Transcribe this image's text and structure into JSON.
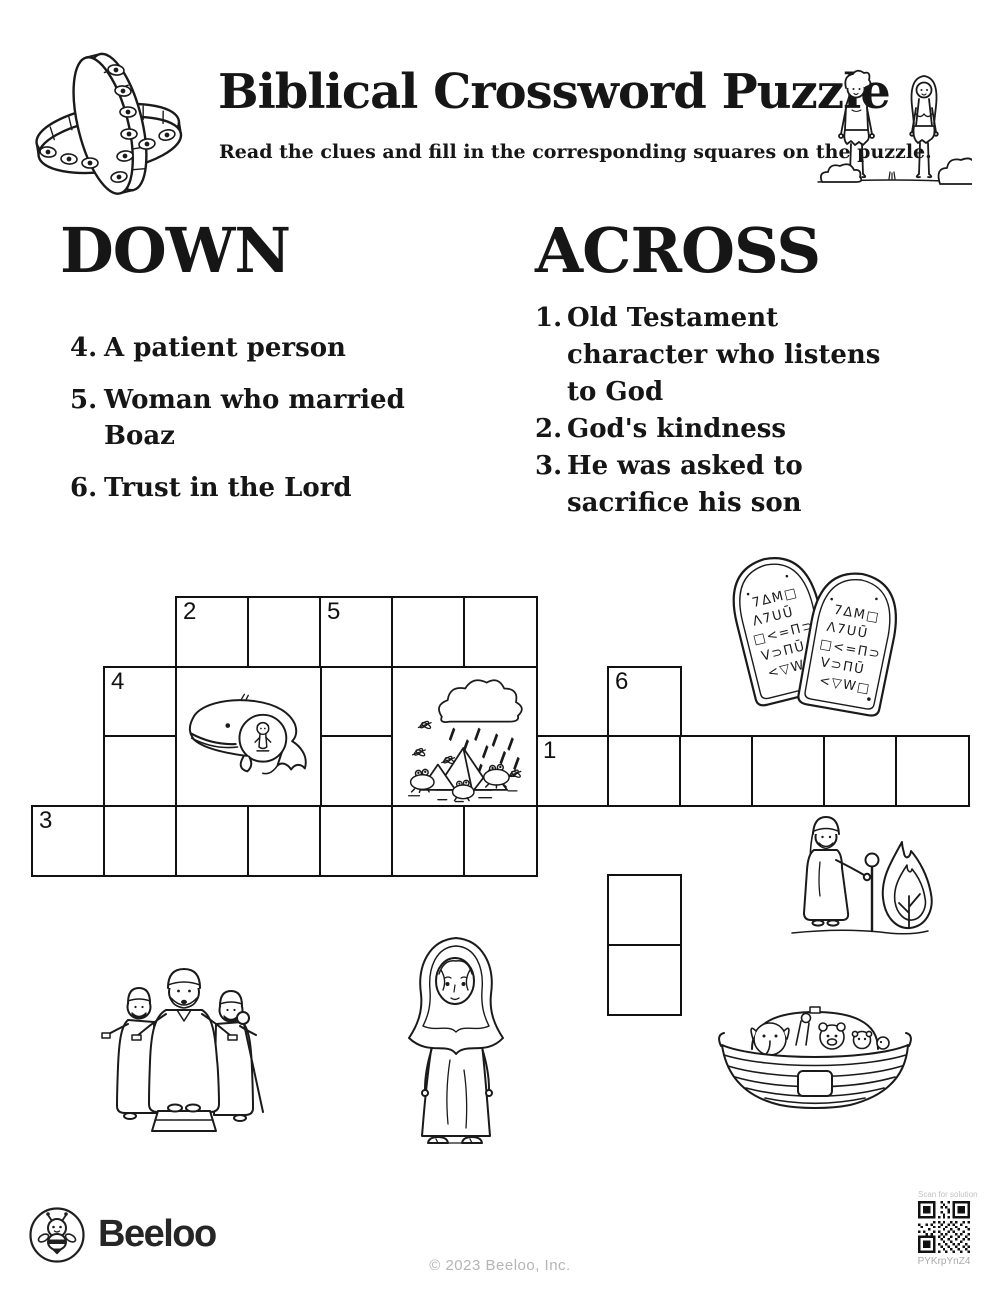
{
  "header": {
    "title": "Biblical Crossword Puzzle",
    "subtitle": "Read the clues and fill in the corresponding squares on the puzzle."
  },
  "clues": {
    "down": {
      "heading": "DOWN",
      "items": [
        {
          "num": "4.",
          "text": "A patient person"
        },
        {
          "num": "5.",
          "text": "Woman who married Boaz"
        },
        {
          "num": "6.",
          "text": "Trust in the Lord"
        }
      ]
    },
    "across": {
      "heading": "ACROSS",
      "items": [
        {
          "num": "1.",
          "text": "Old Testament character who listens to God"
        },
        {
          "num": "2.",
          "text": "God's kindness"
        },
        {
          "num": "3.",
          "text": "He was asked to sacrifice his son"
        }
      ]
    }
  },
  "grid": {
    "cells": [
      {
        "c": 2,
        "r": 0,
        "n": "2"
      },
      {
        "c": 3,
        "r": 0
      },
      {
        "c": 4,
        "r": 0,
        "n": "5"
      },
      {
        "c": 5,
        "r": 0
      },
      {
        "c": 6,
        "r": 0
      },
      {
        "c": 1,
        "r": 1,
        "n": "4"
      },
      {
        "c": 4,
        "r": 1
      },
      {
        "c": 8,
        "r": 1,
        "n": "6"
      },
      {
        "c": 1,
        "r": 2
      },
      {
        "c": 4,
        "r": 2
      },
      {
        "c": 7,
        "r": 2,
        "n": "1"
      },
      {
        "c": 8,
        "r": 2
      },
      {
        "c": 9,
        "r": 2
      },
      {
        "c": 10,
        "r": 2
      },
      {
        "c": 11,
        "r": 2
      },
      {
        "c": 12,
        "r": 2
      },
      {
        "c": 0,
        "r": 3,
        "n": "3"
      },
      {
        "c": 1,
        "r": 3
      },
      {
        "c": 2,
        "r": 3
      },
      {
        "c": 3,
        "r": 3
      },
      {
        "c": 4,
        "r": 3
      },
      {
        "c": 5,
        "r": 3
      },
      {
        "c": 6,
        "r": 3
      },
      {
        "c": 8,
        "r": 4
      },
      {
        "c": 8,
        "r": 5
      }
    ],
    "image_cells": [
      "jonah-whale",
      "plagues-of-egypt"
    ]
  },
  "illustrations": {
    "top_left": "ophanim-eye-rings-cross",
    "top_right": "adam-and-eve",
    "grid_right": "ten-commandments-tablets",
    "mid_right": "moses-burning-bush",
    "bottom_left": "three-robed-men",
    "bottom_center": "veiled-woman",
    "bottom_right": "noahs-ark"
  },
  "footer": {
    "brand": "Beeloo",
    "copyright": "© 2023 Beeloo, Inc.",
    "qr_label": "Scan for solution",
    "qr_code": "PYKrpYnZ4"
  }
}
